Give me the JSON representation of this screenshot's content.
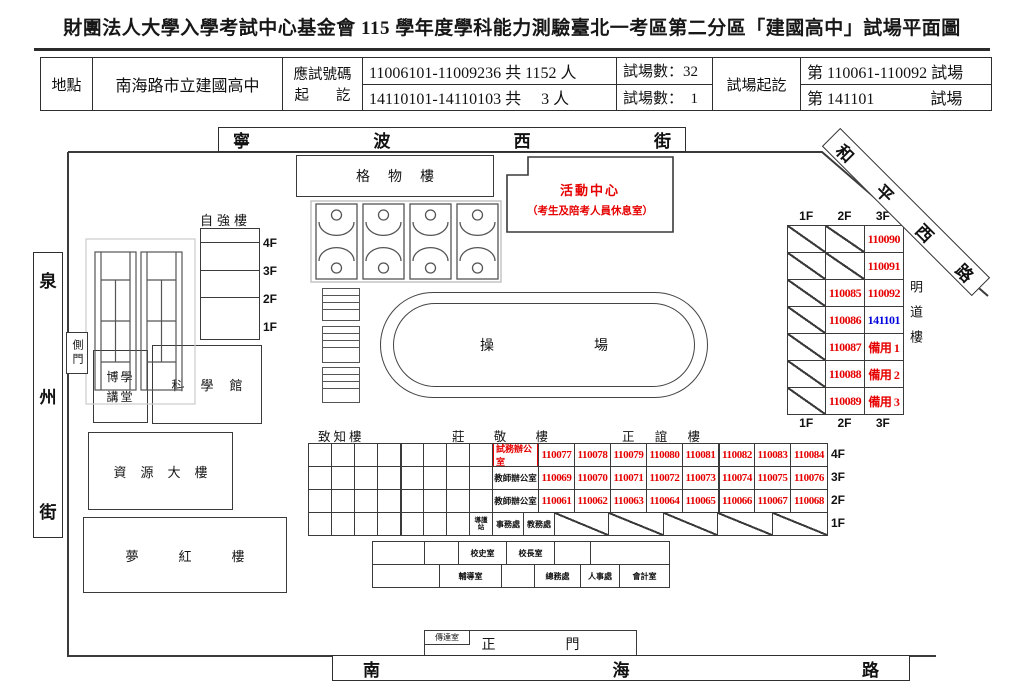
{
  "title": "財團法人大學入學考試中心基金會 115 學年度學科能力測驗臺北一考區第二分區「建國高中」試場平面圖",
  "info_table": {
    "location_label": "地點",
    "location_value": "南海路市立建國高中",
    "id_label_line1": "應試號碼",
    "id_label_line2": "起訖",
    "id_range_1": "11006101-11009236 共 1152 人",
    "id_range_2": "14110101-14110103 共　 3 人",
    "room_count_1": "試場數：32",
    "room_count_2": "試場數：  1",
    "room_range_label": "試場起訖",
    "room_range_1": "第 110061-110092 試場",
    "room_range_2": "第 141101　　　  試場"
  },
  "streets": {
    "top": "寧波西街",
    "right": "和平西路",
    "left": "泉州街",
    "bottom": "南海路"
  },
  "buildings": {
    "gewu": "格物樓",
    "activity_center": "活動中心",
    "activity_center_note": "（考生及陪考人員休息室）",
    "ziqiang": "自強樓",
    "ziqiang_floors": [
      "4F",
      "3F",
      "2F",
      "1F"
    ],
    "side_gate": "側門",
    "boxue_line1": "博學",
    "boxue_line2": "講堂",
    "science_hall": "科學館",
    "resource": "資源大樓",
    "menghong": "夢紅樓",
    "track": "操場",
    "zhizhi": "致知樓",
    "zhuangjing": "莊敬樓",
    "zhengyi": "正誼樓",
    "mingdao": "明道樓",
    "gatehouse": "傳達室",
    "main_gate": "正門"
  },
  "colors": {
    "room_red": "#e60000",
    "room_blue": "#0000dd"
  },
  "mingdao": {
    "floor_labels": [
      "1F",
      "2F",
      "3F"
    ],
    "rows": [
      [
        {
          "d": 1
        },
        {
          "d": 1
        },
        {
          "t": "110090",
          "c": "red"
        }
      ],
      [
        {
          "d": 1
        },
        {
          "d": 1
        },
        {
          "t": "110091",
          "c": "red"
        }
      ],
      [
        {
          "d": 1
        },
        {
          "t": "110085",
          "c": "red"
        },
        {
          "t": "110092",
          "c": "red"
        }
      ],
      [
        {
          "d": 1
        },
        {
          "t": "110086",
          "c": "red"
        },
        {
          "t": "141101",
          "c": "blue"
        }
      ],
      [
        {
          "d": 1
        },
        {
          "t": "110087",
          "c": "red"
        },
        {
          "t": "備用 1",
          "c": "red"
        }
      ],
      [
        {
          "d": 1
        },
        {
          "t": "110088",
          "c": "red"
        },
        {
          "t": "備用 2",
          "c": "red"
        }
      ],
      [
        {
          "d": 1
        },
        {
          "t": "110089",
          "c": "red"
        },
        {
          "t": "備用 3",
          "c": "red"
        }
      ]
    ]
  },
  "grids": {
    "south": {
      "rows": [
        {
          "floor": "4F",
          "cells": [
            {
              "w": 23
            },
            {
              "w": 23
            },
            {
              "w": 23
            },
            {
              "w": 23
            },
            {
              "w": 23,
              "bl": 1
            },
            {
              "w": 23
            },
            {
              "w": 23
            },
            {
              "w": 23
            },
            {
              "w": 46,
              "t": "試務辦公室",
              "cls": "office-red",
              "boxed": 1
            },
            {
              "w": 36,
              "t": "110077",
              "cls": "num"
            },
            {
              "w": 36,
              "t": "110078",
              "cls": "num"
            },
            {
              "w": 36,
              "t": "110079",
              "cls": "num"
            },
            {
              "w": 36,
              "t": "110080",
              "cls": "num"
            },
            {
              "w": 36,
              "t": "110081",
              "cls": "num"
            },
            {
              "w": 36,
              "t": "110082",
              "cls": "num",
              "bl": 1
            },
            {
              "w": 36,
              "t": "110083",
              "cls": "num"
            },
            {
              "w": 36,
              "t": "110084",
              "cls": "num",
              "g": 1
            }
          ]
        },
        {
          "floor": "3F",
          "cells": [
            {
              "w": 23
            },
            {
              "w": 23
            },
            {
              "w": 23
            },
            {
              "w": 23
            },
            {
              "w": 23,
              "bl": 1
            },
            {
              "w": 23
            },
            {
              "w": 23
            },
            {
              "w": 23
            },
            {
              "w": 46,
              "t": "教師辦公室",
              "cls": "office-black"
            },
            {
              "w": 36,
              "t": "110069",
              "cls": "num"
            },
            {
              "w": 36,
              "t": "110070",
              "cls": "num"
            },
            {
              "w": 36,
              "t": "110071",
              "cls": "num"
            },
            {
              "w": 36,
              "t": "110072",
              "cls": "num"
            },
            {
              "w": 36,
              "t": "110073",
              "cls": "num"
            },
            {
              "w": 36,
              "t": "110074",
              "cls": "num",
              "bl": 1
            },
            {
              "w": 36,
              "t": "110075",
              "cls": "num"
            },
            {
              "w": 36,
              "t": "110076",
              "cls": "num",
              "g": 1
            }
          ]
        },
        {
          "floor": "2F",
          "cells": [
            {
              "w": 23
            },
            {
              "w": 23
            },
            {
              "w": 23
            },
            {
              "w": 23
            },
            {
              "w": 23,
              "bl": 1
            },
            {
              "w": 23
            },
            {
              "w": 23
            },
            {
              "w": 23
            },
            {
              "w": 46,
              "t": "教師辦公室",
              "cls": "office-black"
            },
            {
              "w": 36,
              "t": "110061",
              "cls": "num"
            },
            {
              "w": 36,
              "t": "110062",
              "cls": "num"
            },
            {
              "w": 36,
              "t": "110063",
              "cls": "num"
            },
            {
              "w": 36,
              "t": "110064",
              "cls": "num"
            },
            {
              "w": 36,
              "t": "110065",
              "cls": "num"
            },
            {
              "w": 36,
              "t": "110066",
              "cls": "num",
              "bl": 1
            },
            {
              "w": 36,
              "t": "110067",
              "cls": "num"
            },
            {
              "w": 36,
              "t": "110068",
              "cls": "num",
              "g": 1
            }
          ]
        },
        {
          "floor": "1F",
          "cells": [
            {
              "w": 23
            },
            {
              "w": 23
            },
            {
              "w": 23
            },
            {
              "w": 23
            },
            {
              "w": 23,
              "bl": 1
            },
            {
              "w": 23
            },
            {
              "w": 23
            },
            {
              "w": 23,
              "t": "導護站",
              "cls": "tiny2"
            },
            {
              "w": 31,
              "t": "事務處",
              "cls": "mini"
            },
            {
              "w": 31,
              "t": "教務處",
              "cls": "mini"
            },
            {
              "d": 1,
              "g": 1,
              "w": 52
            },
            {
              "d": 1,
              "g": 1,
              "w": 52
            },
            {
              "d": 1,
              "g": 1,
              "w": 52
            },
            {
              "d": 1,
              "g": 1,
              "w": 52
            },
            {
              "d": 1,
              "g": 1,
              "w": 52
            }
          ]
        }
      ]
    },
    "offices": {
      "rows": [
        {
          "cells": [
            {
              "w": 52
            },
            {
              "w": 34
            },
            {
              "w": 48,
              "t": "校史室",
              "cls": "mini"
            },
            {
              "w": 48,
              "t": "校長室",
              "cls": "mini"
            },
            {
              "w": 36
            },
            {
              "g": 1,
              "w": 78
            }
          ]
        },
        {
          "cells": [
            {
              "w": 67
            },
            {
              "w": 62,
              "t": "輔導室",
              "cls": "mini"
            },
            {
              "w": 33
            },
            {
              "w": 46,
              "t": "總務處",
              "cls": "mini"
            },
            {
              "w": 39,
              "t": "人事處",
              "cls": "mini"
            },
            {
              "g": 1,
              "w": 49,
              "t": "會計室",
              "cls": "mini"
            }
          ]
        }
      ]
    }
  },
  "south_floor_labels": [
    "4F",
    "3F",
    "2F",
    "1F"
  ]
}
